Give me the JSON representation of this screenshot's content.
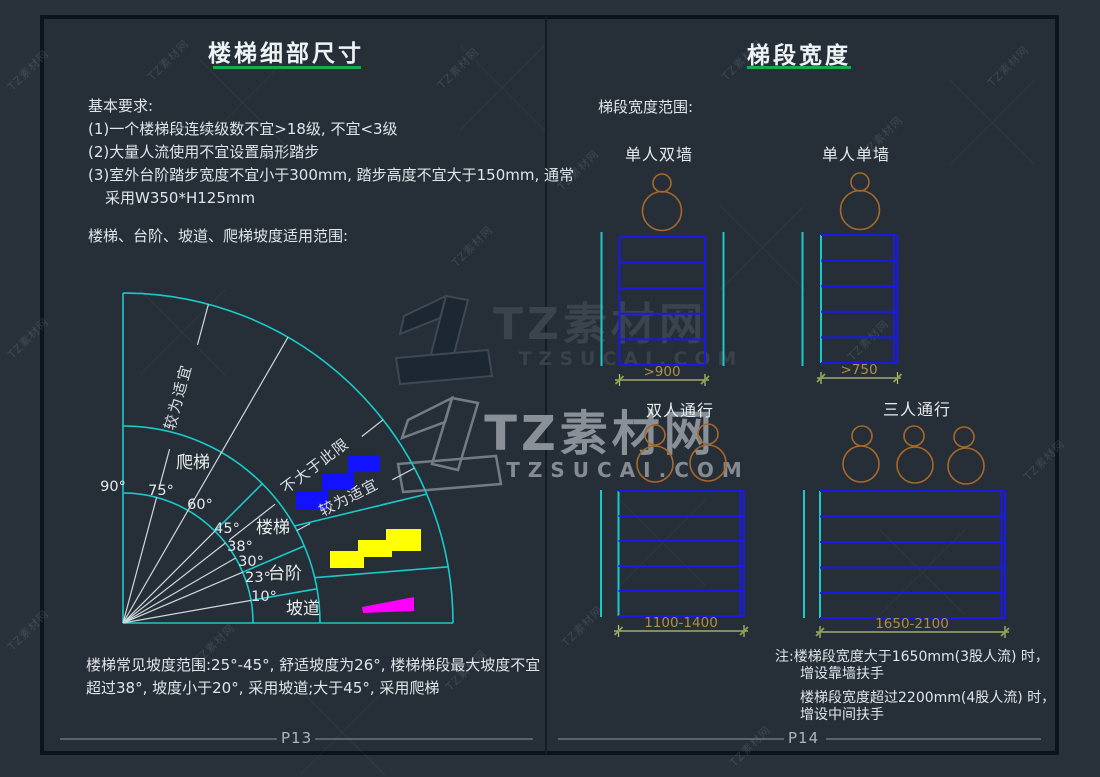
{
  "watermark": {
    "brand": "TZ素材网",
    "domain": "TZSUCAI.COM",
    "tile": "TZ素材网"
  },
  "left_page": {
    "title": "楼梯细部尺寸",
    "requirements_heading": "基本要求:",
    "requirements": [
      "(1)一个楼梯段连续级数不宜>18级, 不宜<3级",
      "(2)大量人流使用不宜设置扇形踏步",
      "(3)室外台阶踏步宽度不宜小于300mm, 踏步高度不宜大于150mm, 通常",
      "采用W350*H125mm"
    ],
    "slope_heading": "楼梯、台阶、坡道、爬梯坡度适用范围:",
    "fan": {
      "type": "polar-fan",
      "angles": [
        90,
        75,
        60,
        45,
        38,
        30,
        23,
        10
      ],
      "angle_labels": [
        "90°",
        "75°",
        "60°",
        "45°",
        "38°",
        "30°",
        "23°",
        "10°"
      ],
      "sector_labels": [
        "爬梯",
        "楼梯",
        "台阶",
        "坡道"
      ],
      "annotation_upper": "较为适宜",
      "annotation_limit": "不大于此限",
      "annotation_suitable": "较为适宜"
    },
    "footnote": [
      "楼梯常见坡度范围:25°-45°, 舒适坡度为26°, 楼梯梯段最大坡度不宜",
      "超过38°, 坡度小于20°, 采用坡道;大于45°, 采用爬梯"
    ],
    "page_number": "P13"
  },
  "right_page": {
    "title": "梯段宽度",
    "range_heading": "梯段宽度范围:",
    "diagrams": [
      {
        "label": "单人双墙",
        "dimension": ">900"
      },
      {
        "label": "单人单墙",
        "dimension": ">750"
      },
      {
        "label": "双人通行",
        "dimension": "1100-1400"
      },
      {
        "label": "三人通行",
        "dimension": "1650-2100"
      }
    ],
    "notes": [
      "注:楼梯段宽度大于1650mm(3股人流) 时，",
      "增设靠墙扶手",
      "楼梯段宽度超过2200mm(4股人流) 时，",
      "增设中间扶手"
    ],
    "page_number": "P14"
  },
  "colors": {
    "cyan_line": "#1ac9c9",
    "blue_line": "#1a1ae8",
    "stair_icon_blue": "#1212ff",
    "stair_icon_yellow": "#ffff00",
    "ramp_icon_magenta": "#ff00ff",
    "green_underline": "#0fae4e",
    "person_orange": "#a8682a",
    "dimension_line": "#b9c37e",
    "dimension_text": "#b09045",
    "page_background": "#262e37"
  }
}
